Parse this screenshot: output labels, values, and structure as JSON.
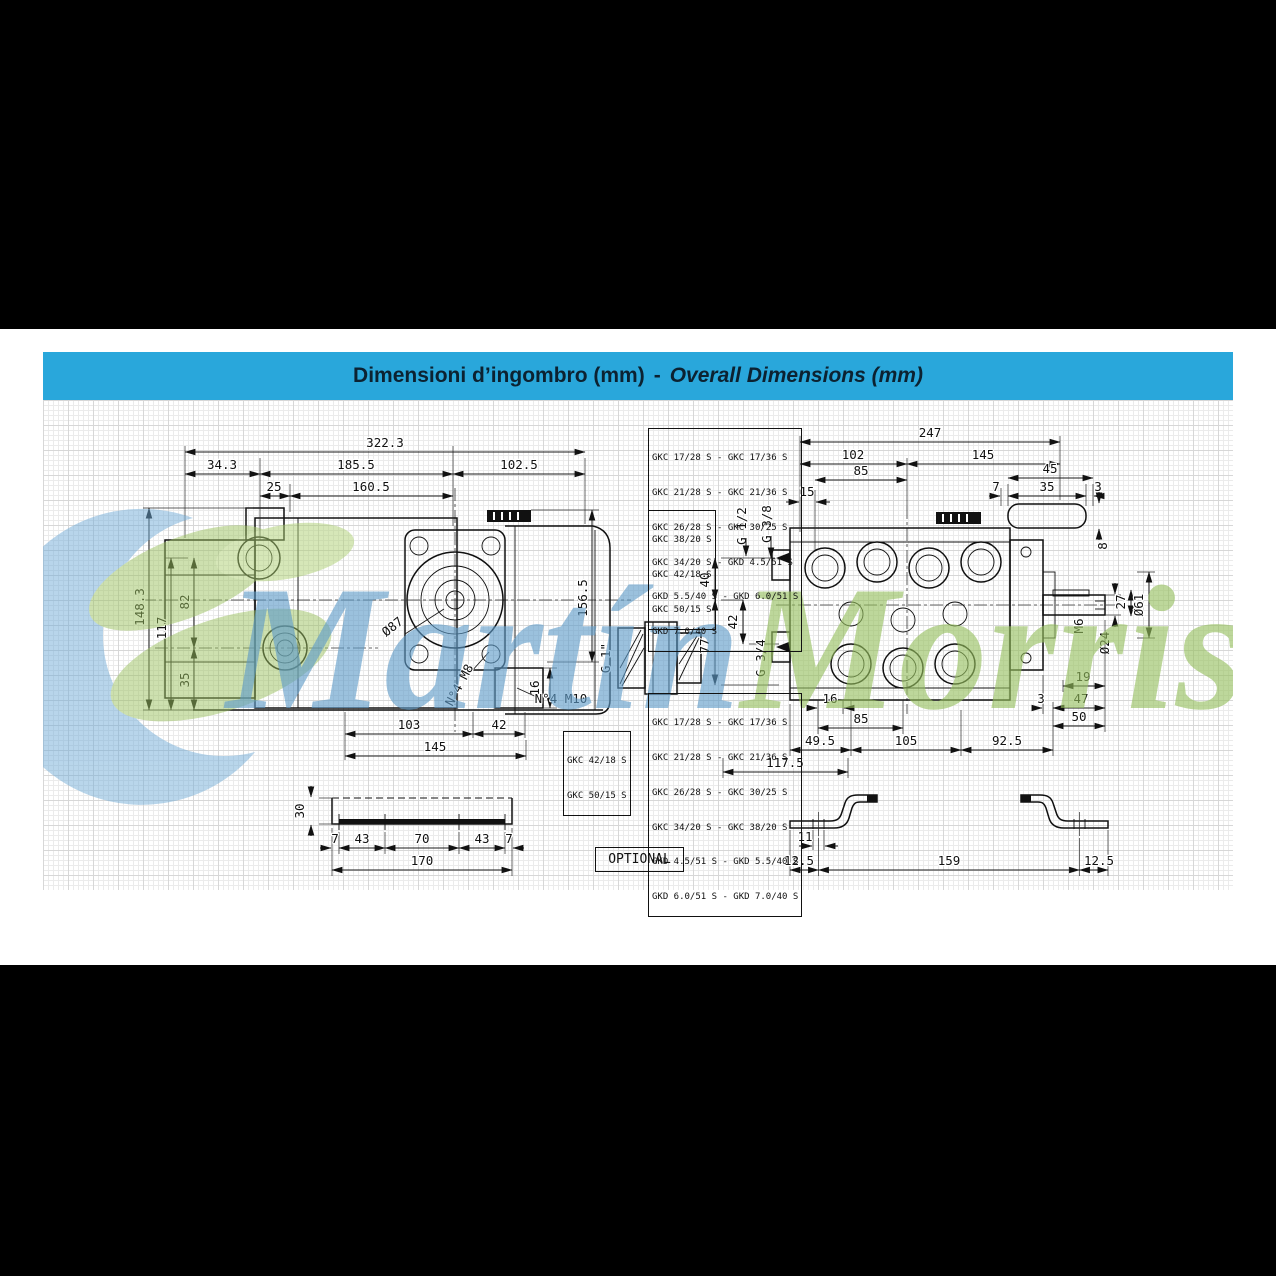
{
  "title_bar": {
    "it": "Dimensioni d’ingombro (mm)",
    "sep": "-",
    "en": "Overall Dimensions (mm)"
  },
  "watermark": {
    "word1": "Martín",
    "word2": "Morris"
  },
  "tables": {
    "top": [
      "GKC 17/28 S - GKC 17/36 S",
      "GKC 21/28 S - GKC 21/36 S",
      "GKC 26/28 S - GKC 30/25 S",
      "GKC 34/20 S - GKD 4.5/51 S",
      "GKD 5.5/40 S - GKD 6.0/51 S",
      "GKD 7.0/40 S"
    ],
    "side": [
      "GKC 38/20 S",
      "GKC 42/18 S",
      "GKC 50/15 S"
    ],
    "bottom": [
      "GKC 17/28 S - GKC 17/36 S",
      "GKC 21/28 S - GKC 21/36 S",
      "GKC 26/28 S - GKC 30/25 S",
      "GKC 34/20 S - GKC 38/20 S",
      "GKD 4.5/51 S - GKD 5.5/40 S",
      "GKD 6.0/51 S - GKD 7.0/40 S"
    ],
    "bottom_left": [
      "GKC 42/18 S",
      "GKC 50/15 S"
    ]
  },
  "side_view": {
    "total": "322.3",
    "a343": "34.3",
    "a1855": "185.5",
    "a1025": "102.5",
    "a25": "25",
    "a1605": "160.5",
    "h1483": "148.3",
    "h117": "117",
    "h82": "82",
    "h35": "35",
    "h1565": "156.5",
    "flange_dia": "Ø87",
    "screws_m8": "N°4 M8",
    "screws_m10": "N°4 M10",
    "foot16": "16",
    "b103": "103",
    "b42": "42",
    "b145": "145",
    "port_g1": "G 1\""
  },
  "ports": {
    "g12": "G 1/2",
    "g38": "G 3/8",
    "g34": "G 3/4",
    "v40": "40",
    "v42": "42",
    "v77": "77"
  },
  "top_view": {
    "total": "247",
    "a102": "102",
    "a145": "145",
    "a85": "85",
    "a15": "15",
    "key45": "45",
    "key7": "7",
    "key35": "35",
    "key3": "3",
    "key8": "8",
    "m6": "M6",
    "dia24": "Ø24",
    "s27": "27",
    "dia61": "Ø61",
    "r19": "19",
    "r3": "3",
    "r47": "47",
    "r50": "50",
    "b16": "16",
    "b85": "85",
    "b495": "49.5",
    "b105": "105",
    "b925": "92.5",
    "b1175": "117.5"
  },
  "rail": {
    "h30": "30",
    "s7a": "7",
    "s43a": "43",
    "s70": "70",
    "s43b": "43",
    "s7b": "7",
    "total": "170"
  },
  "bracket": {
    "w11": "11",
    "l125a": "12.5",
    "l159": "159",
    "l125b": "12.5"
  },
  "optional_label": "OPTIONAL"
}
